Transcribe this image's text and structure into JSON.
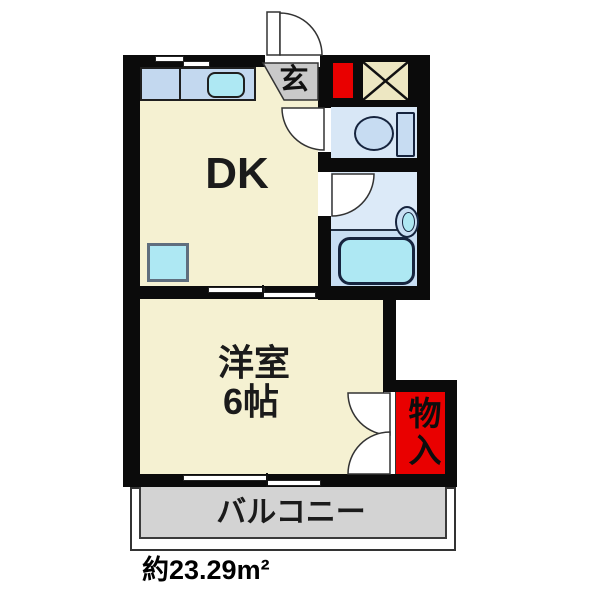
{
  "floor_plan": {
    "rooms": {
      "dk": {
        "label": "DK"
      },
      "genkan": {
        "label": "玄"
      },
      "western_room": {
        "label": "洋室",
        "size_label": "6帖"
      },
      "storage": {
        "label": "物入"
      },
      "balcony": {
        "label": "バルコニー"
      }
    },
    "total_area": "約23.29m²",
    "fixtures": [
      "kitchen-sink",
      "toilet",
      "washbasin",
      "bathtub",
      "washing-machine-pan"
    ],
    "colors": {
      "wall_black": "#0b0b0b",
      "room_cream": "#F5F1D2",
      "counter_blue": "#C3D8EF",
      "toilet_blue": "#D8E7F6",
      "washroom_blue": "#DCEAF8",
      "tub_area_blue": "#C8DEF3",
      "fixture_cyan": "#AEE8F3",
      "genkan_gray": "#C9C9C9",
      "balcony_gray": "#D3D3D3",
      "accent_red": "#E90000",
      "storage_tan": "#EDE7C2"
    }
  }
}
